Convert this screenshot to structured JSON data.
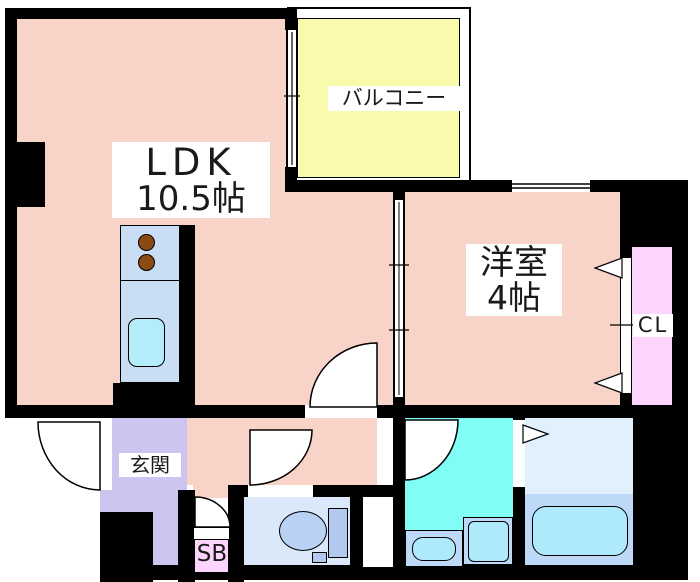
{
  "rooms": {
    "ldk": {
      "name": "LDK",
      "size": "10.5帖"
    },
    "western": {
      "name": "洋室",
      "size": "4帖"
    },
    "balcony": {
      "name": "バルコニー"
    },
    "entrance": {
      "name": "玄関"
    },
    "closet": {
      "name": "CL"
    },
    "shoebox": {
      "name": "SB"
    }
  },
  "palette": {
    "wall": "#000000",
    "room_pink": "#f8d3c7",
    "balcony_yellow": "#fafaad",
    "entrance_purple": "#cdc5f0",
    "closet_pink": "#fdd4fb",
    "aqua": "#80fdf5",
    "light_blue_room": "#dbe8fa",
    "fixture_blue": "#bed9f7",
    "fixture_aqua": "#aeeafc",
    "counter_blue": "#c9def4",
    "sink_aqua": "#b4ecfa",
    "burner_brown": "#8a4a14",
    "bath_top": "#e0f0fc",
    "toilet_blue": "#b9d2f4",
    "tank_blue": "#b3c8ee"
  }
}
